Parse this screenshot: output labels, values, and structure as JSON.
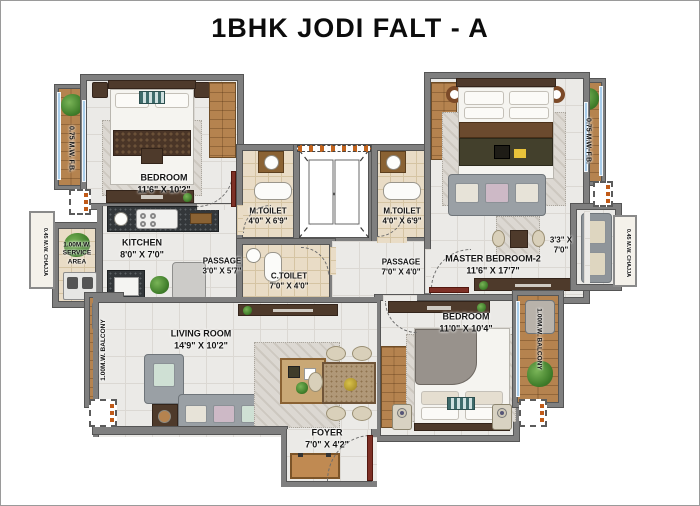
{
  "title": "1BHK JODI FALT - A",
  "rooms": {
    "bedroom1": {
      "name": "BEDROOM",
      "dims": "11'6\" X 10'2\""
    },
    "kitchen": {
      "name": "KITCHEN",
      "dims": "8'0\" X 7'0\""
    },
    "service_area": {
      "line1": "1.00M.W.",
      "line2": "SERVICE",
      "line3": "AREA"
    },
    "passage_left": {
      "name": "PASSAGE",
      "dims": "3'0\" X 5'7\""
    },
    "m_toilet_left": {
      "name": "M.TOILET",
      "dims": "4'0\" X 6'9\""
    },
    "c_toilet": {
      "name": "C.TOILET",
      "dims": "7'0\" X 4'0\""
    },
    "m_toilet_right": {
      "name": "M.TOILET",
      "dims": "4'0\" X 6'9\""
    },
    "passage_right": {
      "name": "PASSAGE",
      "dims": "7'0\" X 4'0\""
    },
    "master_bedroom2": {
      "name": "MASTER BEDROOM-2",
      "dims": "11'6\" X 17'7\""
    },
    "niche": {
      "dims_line1": "3'3\" X",
      "dims_line2": "7'0\""
    },
    "bedroom2": {
      "name": "BEDROOM",
      "dims": "11'0\" X 10'4\""
    },
    "living_room": {
      "name": "LIVING ROOM",
      "dims": "14'9\" X 10'2\""
    },
    "foyer": {
      "name": "FOYER",
      "dims": "7'0\" X 4'2\""
    }
  },
  "annotations": {
    "fb_left": "0.75 M.W. F.B.",
    "fb_right": "0.75 M.W. F.B.",
    "chajja_left": "0.45 M.W. CHAJJA",
    "chajja_right": "0.45 M.W. CHAJJA",
    "balcony_left": "1.00M.W. BALCONY",
    "balcony_right": "1.00M.W. BALCONY"
  },
  "colors": {
    "wall": "#7f7f7f",
    "window": "#a9cdea",
    "wood_deck": "#b5834f",
    "door": "#7e3026",
    "floor": "#ebeae7",
    "toilet_floor": "#e9dcc6"
  }
}
